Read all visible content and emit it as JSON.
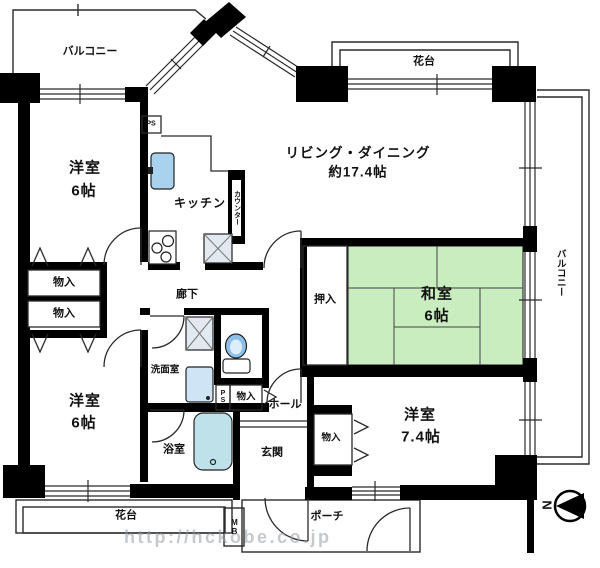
{
  "plan": {
    "outdoor": {
      "balcony_top": "バルコニー",
      "balcony_right": "バルコニー",
      "flower_stand_top": "花台",
      "flower_stand_bottom": "花台",
      "porch": "ポーチ"
    },
    "rooms": {
      "living_dining": {
        "name": "リビング・ダイニング",
        "size": "約17.4帖"
      },
      "japanese_room": {
        "name": "和室",
        "size": "6帖"
      },
      "western_room_top_left": {
        "name": "洋室",
        "size": "6帖"
      },
      "western_room_bottom_left": {
        "name": "洋室",
        "size": "6帖"
      },
      "western_room_bottom_right": {
        "name": "洋室",
        "size": "7.4帖"
      },
      "kitchen": {
        "name": "キッチン"
      },
      "washroom": {
        "name": "洗面室"
      },
      "bathroom": {
        "name": "浴室"
      },
      "hallway": {
        "name": "廊下"
      },
      "hall": {
        "name": "ホール"
      },
      "entrance": {
        "name": "玄関"
      }
    },
    "storage": {
      "closet_top_1": "物入",
      "closet_top_2": "物入",
      "closet_middle": "物入",
      "closet_bottom_right": "物入",
      "oshiire": "押入"
    },
    "labels": {
      "counter": "カウンター",
      "pipe_space_kitchen": "PS",
      "pipe_space_hall": "PS",
      "meter_box": "MB",
      "compass_north": "N"
    },
    "watermark": "http://hckobe.co.jp",
    "colors": {
      "wall": "#000000",
      "tatami_green": "#c9edbe",
      "sink_blue": "#a9d2ee",
      "bath_cyan": "#bfe2ea",
      "toilet_blue": "#8cc0e8",
      "hatch_gray": "#e3e9f0"
    }
  }
}
